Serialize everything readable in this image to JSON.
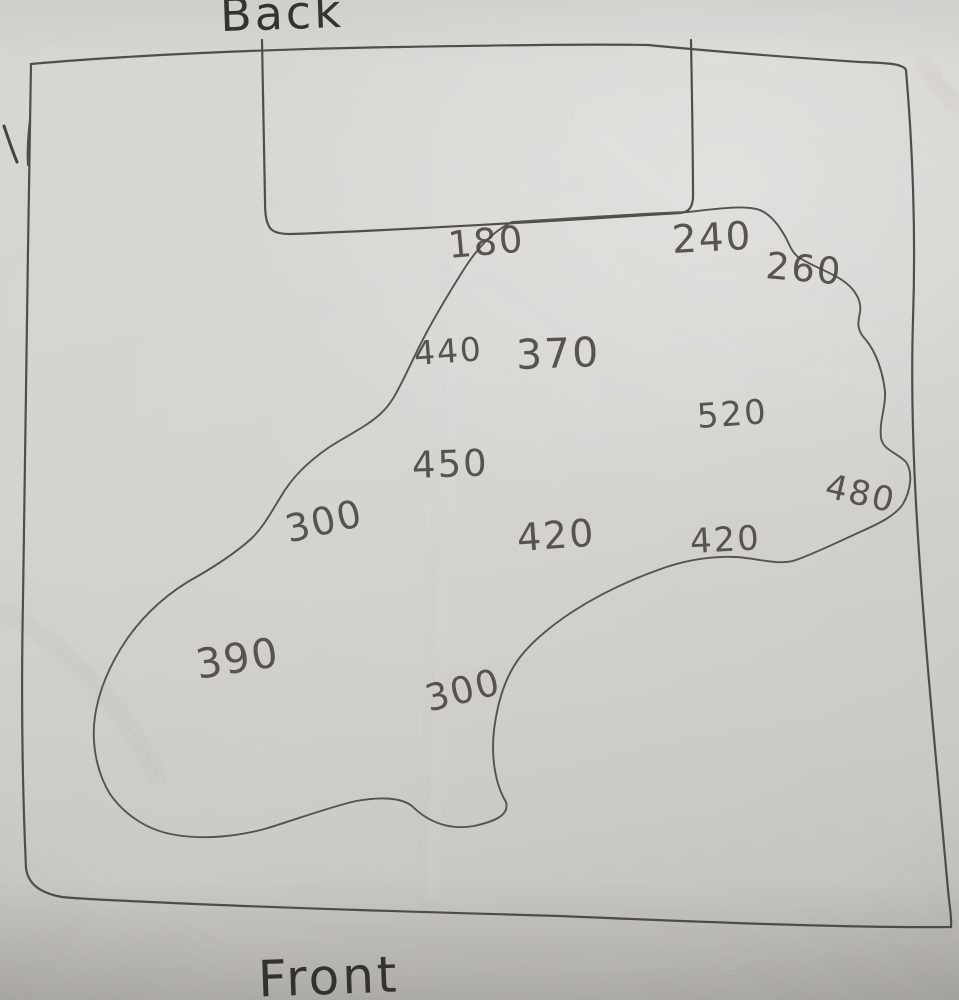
{
  "sketch": {
    "type": "hand-drawn map",
    "orientation_labels": {
      "top": "Back",
      "bottom": "Front"
    },
    "colors": {
      "paper": "#d3d1cd",
      "pencil_line": "#504e49",
      "pencil_text": "#4b4943",
      "label_text": "#353330"
    },
    "regions": [
      {
        "name": "outer-boundary",
        "shape": "rectangle"
      },
      {
        "name": "top-notch",
        "shape": "rectangular inset at top"
      },
      {
        "name": "pond-outline",
        "shape": "irregular closed blob"
      }
    ]
  },
  "readings": [
    {
      "value": "180",
      "x": 448,
      "y": 224,
      "size": 37,
      "rot": -5
    },
    {
      "value": "240",
      "x": 672,
      "y": 218,
      "size": 39,
      "rot": -3
    },
    {
      "value": "260",
      "x": 766,
      "y": 244,
      "size": 37,
      "rot": 5
    },
    {
      "value": "440",
      "x": 414,
      "y": 334,
      "size": 33,
      "rot": -4
    },
    {
      "value": "370",
      "x": 516,
      "y": 331,
      "size": 41,
      "rot": -2
    },
    {
      "value": "520",
      "x": 697,
      "y": 397,
      "size": 34,
      "rot": -4
    },
    {
      "value": "450",
      "x": 412,
      "y": 444,
      "size": 37,
      "rot": -2
    },
    {
      "value": "480",
      "x": 826,
      "y": 466,
      "size": 34,
      "rot": 13
    },
    {
      "value": "300",
      "x": 286,
      "y": 508,
      "size": 38,
      "rot": -13
    },
    {
      "value": "420",
      "x": 517,
      "y": 516,
      "size": 38,
      "rot": -4
    },
    {
      "value": "420",
      "x": 690,
      "y": 522,
      "size": 34,
      "rot": -3
    },
    {
      "value": "390",
      "x": 196,
      "y": 641,
      "size": 41,
      "rot": -9
    },
    {
      "value": "300",
      "x": 426,
      "y": 678,
      "size": 37,
      "rot": -14
    }
  ]
}
